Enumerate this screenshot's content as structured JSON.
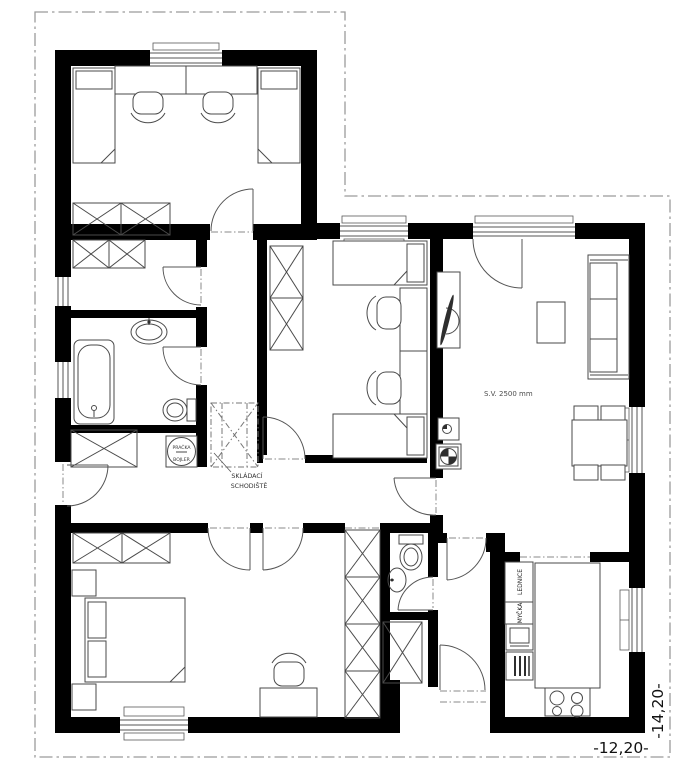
{
  "labels": {
    "ceiling_height": "S.V. 2500 mm",
    "folding_stairs": [
      "SKLÁDACÍ",
      "SCHODIŠTĚ"
    ],
    "washer_boiler": [
      "PRAČKA",
      "BOJLER"
    ],
    "dishwasher": "MYČKA",
    "fridge": "LEDNICE"
  },
  "dimensions": {
    "width_label": "-12,20-",
    "height_label": "-14,20-"
  },
  "colors": {
    "wall": "#000000",
    "furniture_line": "#4a4a4a",
    "boundary_dash": "#9b9b9b",
    "fridge_text": "#b5b5b5",
    "background": "#ffffff"
  }
}
